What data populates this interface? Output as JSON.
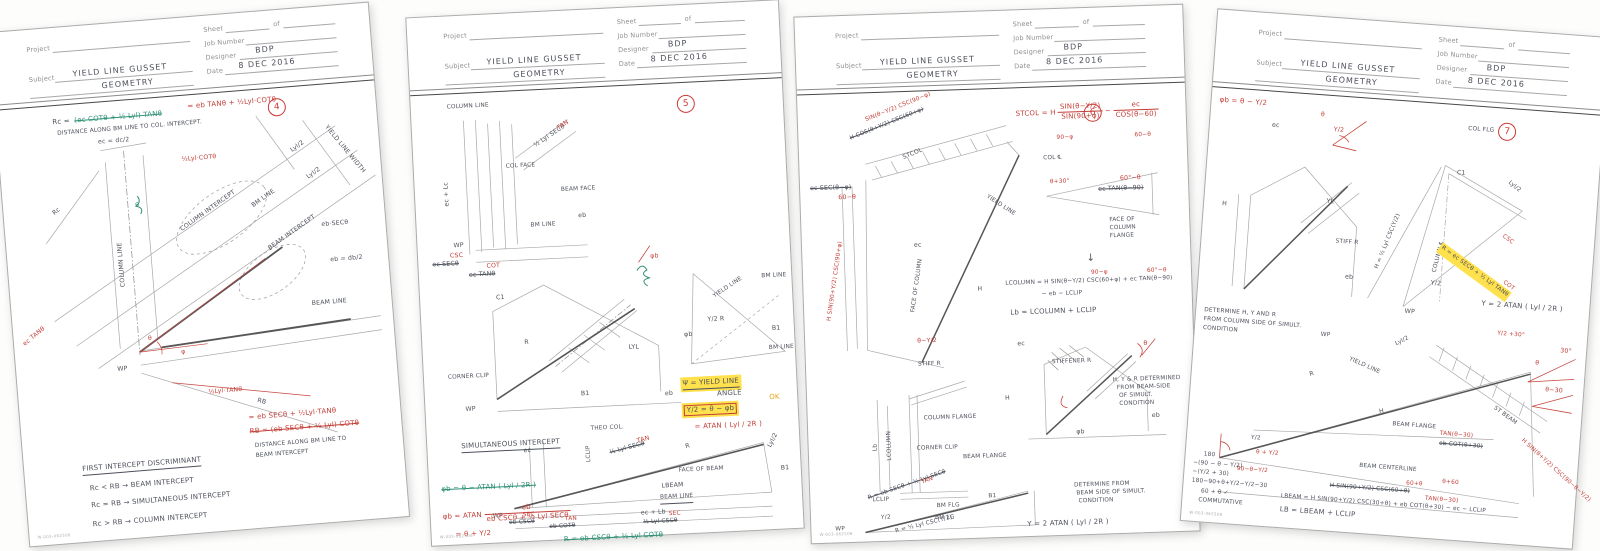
{
  "form": {
    "project": "Project",
    "sheet": "Sheet",
    "of": "of",
    "job": "Job Number",
    "subject": "Subject",
    "designer": "Designer",
    "date": "Date",
    "code": "W-003-062508"
  },
  "sheets": [
    {
      "page": "4",
      "subject1": "YIELD LINE GUSSET",
      "subject2": "GEOMETRY",
      "designer": "BDP",
      "date": "8 DEC 2016",
      "t": {
        "rc_lhs": "Rc =",
        "rc_old": "(ec COTθ + ½ Lyl) TANθ",
        "rc_new": "= eb TANθ + ½Lyl·COTθ",
        "note_top": "DISTANCE ALONG BM LINE TO COL. INTERCEPT.",
        "ec_dc": "ec = dc/2",
        "lyl_cot": "½Lyl·COTθ",
        "rc": "Rc",
        "col_line": "COLUMN LINE",
        "lyl2a": "Lyl/2",
        "lyl2b": "Lyl/2",
        "ylw": "YIELD LINE WIDTH",
        "col_int": "COLUMN INTERCEPT",
        "bm_line": "BM LINE",
        "beam_int": "BEAM INTERCEPT",
        "eb_sec": "eb·SECθ",
        "eb_db": "eb = db/2",
        "beam_line": "BEAM LINE",
        "wp": "WP",
        "theta": "θ",
        "phi": "φ",
        "ec_tan": "ec TANθ",
        "lyl_tan": "½Lyl·TANθ",
        "rb": "RB",
        "rb_new": "= eb SECθ + ½Lyl·TANθ",
        "rb_old": "RB = (eb SECθ + ½ Lyl) COTθ",
        "note_rb1": "DISTANCE ALONG BM LINE TO",
        "note_rb2": "BEAM INTERCEPT",
        "disc": "FIRST INTERCEPT DISCRIMINANT",
        "d1": "Rc < RB  →  BEAM INTERCEPT",
        "d2": "Rc = RB  →  SIMULTANEOUS INTERCEPT",
        "d3": "Rc > RB  →  COLUMN INTERCEPT"
      }
    },
    {
      "page": "5",
      "subject1": "YIELD LINE GUSSET",
      "subject2": "GEOMETRY",
      "designer": "BDP",
      "date": "8 DEC 2016",
      "t": {
        "col_line": "COLUMN LINE",
        "ec_lc": "ec + Lc",
        "hyp_top": "½ Lyl SECθ",
        "tan1": "TAN",
        "col_face": "COL FACE",
        "beam_face": "BEAM FACE",
        "bm_line": "BM LINE",
        "wp1": "WP",
        "eb1": "eb",
        "ec_sec": "ec SECθ",
        "csc1": "CSC",
        "ec_tan": "ec TANθ",
        "cot1": "COT",
        "c1": "C1",
        "r1": "R",
        "lyl": "LYL",
        "b1a": "B1",
        "clip": "CORNER CLIP",
        "wp2": "WP",
        "eb2": "eb",
        "phib1": "φb",
        "yline": "YIELD LINE",
        "bm2": "BM LINE",
        "y2r": "Y/2  R",
        "phib2": "φb",
        "b1b": "B1",
        "bm3": "BM LINE",
        "bx1": "Ψ = YIELD LINE",
        "bx1b": "ANGLE",
        "bx2": "Y/2 = θ − φb",
        "ok": "OK",
        "bx3": "= ATAN ( Lyl / 2R )",
        "sim": "SIMULTANEOUS INTERCEPT",
        "theo": "THEO COL.",
        "lclip": "LCLIP",
        "ec2": "ec",
        "hyp2": "½ Lyl SECθ",
        "tan2": "TAN",
        "r2": "R",
        "lyl2": "Lyl/2",
        "b1c": "B1",
        "fob": "FACE OF BEAM",
        "lbeam": "LBEAM",
        "bline": "BEAM LINE",
        "wp3": "WP",
        "ebcsc": "eb CSCθ",
        "sec1": "SEC",
        "ebcot": "eb COTθ",
        "tan3": "TAN",
        "lylcsc": "½ Lyl CSCθ",
        "sec2": "SEC",
        "eclb": "ec + Lb",
        "g1": "φb = θ − ATAN ( Lyl / 2R )",
        "g2": "R = eb CSCθ + ½ Lyl COTθ",
        "rf1": "φb = ATAN",
        "rfn": "eb′",
        "rfd": "eb CSCθ + ½ Lyl SECθ",
        "rf2": "= θ + Y/2"
      }
    },
    {
      "page": "6",
      "subject1": "YIELD LINE GUSSET",
      "subject2": "GEOMETRY",
      "designer": "BDP",
      "date": "8 DEC 2016",
      "t": {
        "band_new": "SIN(θ−Y/2) CSC(90−φ)",
        "band_old": "H COS(θ+Y/2) CSC(60+φ)",
        "st_lhs": "STCOL = H",
        "st_n1": "SIN(θ−Y/2)",
        "st_d1": "SIN(90+φ)",
        "minus": "−",
        "st_n2": "ec",
        "st_d2": "COS(θ−60)",
        "fx1": "90−φ",
        "fx2": "60−θ",
        "stcol": "STCOL",
        "ecsec": "ec SEC(θ−φ)",
        "fx3": "60−θ",
        "hsin": "H SIN(90+Y/2) CSC(90+φ)",
        "focol": "FACE OF COLUMN",
        "ec1": "ec",
        "yline": "YIELD LINE",
        "h1": "H",
        "thy2": "θ−Y/2",
        "colcl": "COL ℄",
        "fx4": "θ+30°",
        "ectan": "ec TAN(θ−90)",
        "fx5": "60°−θ",
        "fof1": "FACE OF",
        "fof2": "COLUMN",
        "fof3": "FLANGE",
        "arrow": "↓",
        "lc1": "LCOLUMN = H SIN(θ−Y/2) CSC(60+φ) + ec TAN(θ−90)",
        "lcfx1": "90−φ",
        "lcfx2": "60°−θ",
        "lc2": "− eb − LCLIP",
        "lb": "Lb = LCOLUMN + LCLIP",
        "stiff": "STIFF R",
        "lbdim": "Lb",
        "lcoldim": "LCOLUMN",
        "cflange": "COLUMN FLANGE",
        "clip": "CORNER CLIP",
        "bflange": "BEAM FLANGE",
        "lclip": "LCLIP",
        "ec2": "ec",
        "stf1": "STIFFENER R",
        "h2": "H",
        "eb1": "eb",
        "phib": "φb",
        "nr1": "H, Y & R DETERMINED",
        "nr2": "FROM BEAM-SIDE",
        "nr3": "OF SIMULT.",
        "nr4": "CONDITION",
        "trir": "R = eb SECθ + ½ Lyl SECθ",
        "trifx": "TAN",
        "bmflg": "BM FLG",
        "b1": "B1",
        "y2": "Y/2",
        "bmlg": "BM LG",
        "wp": "WP",
        "trir2": "R = ½ Lyl CSC(Y/2)",
        "yf": "Y = 2 ATAN ( Lyl / 2R )",
        "nb1": "DETERMINE FROM",
        "nb2": "BEAM SIDE OF SIMULT.",
        "nb3": "CONDITION",
        "th": "θ"
      }
    },
    {
      "page": "7",
      "subject1": "YIELD LINE GUSSET",
      "subject2": "GEOMETRY",
      "designer": "BDP",
      "date": "8 DEC 2016",
      "t": {
        "phit": "φb = θ − Y/2",
        "th1": "θ",
        "ec1": "ec",
        "h1": "H",
        "yl": "YL",
        "stiff": "STIFF R",
        "eb1": "eb",
        "y2r": "Y/2",
        "nl1": "DETERMINE H, Y AND R",
        "nl2": "FROM COLUMN SIDE OF SIMULT.",
        "nl3": "CONDITION",
        "colflg": "COL FLG",
        "hf": "H = ½ Lyl CSC(Y/2)",
        "colcl": "COLUMN ℄",
        "c1": "C1",
        "lyl2a": "Lyl/2",
        "hlf": "R = ec SECθ + ½ Lyl TANθ",
        "fxcsc": "CSC",
        "fxcot": "COT",
        "yf": "Y = 2 ATAN ( Lyl / 2R )",
        "wp1": "WP",
        "y2a": "Y/2",
        "lyl2b": "Lyl/2",
        "yline": "YIELD LINE",
        "wp2": "WP",
        "a1": "θ",
        "a2": "30°",
        "a3": "θ−30",
        "a4": "Y/2 +30°",
        "rdim": "R",
        "hdim": "H",
        "bflange": "BEAM FLANGE",
        "y2b": "Y/2",
        "thy2": "θ + Y/2",
        "bcl": "BEAM CENTERLINE",
        "a5": "90−θ−Y/2",
        "stbeam": "ST BEAM",
        "ebcot": "eb COT(θ+30)",
        "fxtan": "TAN(θ−30)",
        "a6": "θ+60",
        "hsinb": "H SIN(90+Y/2) CSC(60+θ)",
        "fxb": "60+θ",
        "hsinr": "H SIN(θ+Y/2) CSC(90−θ−Y/2)",
        "lbeamf": "LBEAM = H SIN(90+Y/2) CSC(30+θ) + eb COT(θ+30) − ec − LCLIP",
        "lbfx": "TAN(θ−30)",
        "lbf": "LB = LBEAM + LCLIP",
        "m1": "180",
        "m2": "−(90 − θ − Y/2)",
        "m3": "−(Y/2 + 30)",
        "m4": "180−90+θ+Y/2−Y/2−30",
        "m5": "60 + θ  ✓",
        "m6": "COMMUTATIVE"
      }
    }
  ]
}
